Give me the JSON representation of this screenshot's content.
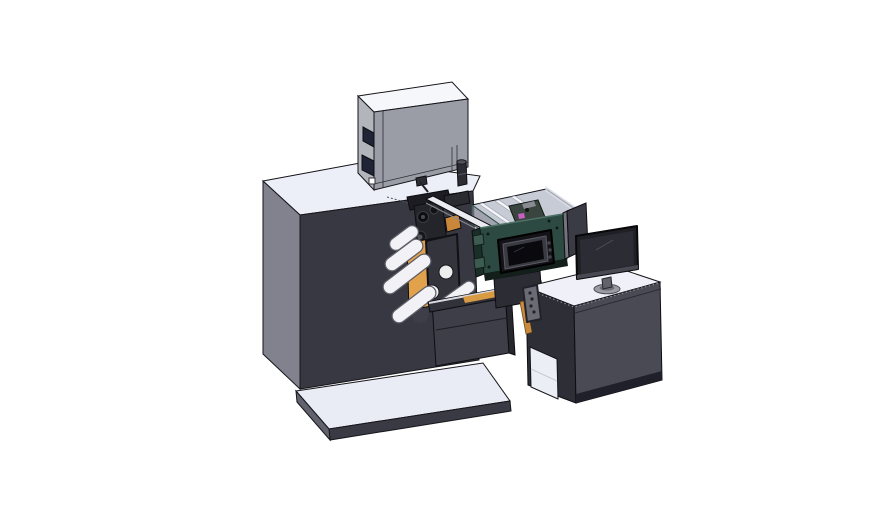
{
  "meta": {
    "width": 888,
    "height": 522,
    "background": "#ffffff",
    "scene": "isometric CAD render of a label printing machine with operator desk"
  },
  "parts": [
    {
      "id": "main-cabinet",
      "label": "main machine cabinet"
    },
    {
      "id": "printer-enclosure",
      "label": "printer enclosure box on cabinet top"
    },
    {
      "id": "top-knob-cylinder",
      "label": "small cylinder fitting on cabinet top"
    },
    {
      "id": "print-mechanism",
      "label": "print head, rollers and orange media roll"
    },
    {
      "id": "media-tray",
      "label": "open tray with carriage and rails"
    },
    {
      "id": "control-unit",
      "label": "teal control box with HMI touch panel"
    },
    {
      "id": "outfeed-pedestal",
      "label": "outfeed pedestal and conveyor beam"
    },
    {
      "id": "side-shield-panel",
      "label": "shield panel behind monitor"
    },
    {
      "id": "operator-desk",
      "label": "operator desk cabinet"
    },
    {
      "id": "monitor",
      "label": "desktop monitor on stand"
    },
    {
      "id": "machine-base-plate",
      "label": "machine base plate"
    }
  ],
  "colors": {
    "background": "#ffffff",
    "cabinet_front": "#383842",
    "cabinet_side": "#82828f",
    "cabinet_top": "#edeff8",
    "box_front": "#9a9da6",
    "box_side": "#b3b5bd",
    "box_top": "#f6f7fb",
    "box_window": "#202437",
    "platform_top": "#e9ebf5",
    "platform_edge": "#3a3a44",
    "platform_side": "#62626e",
    "roller_fill": "#f2f2f6",
    "roller_edge": "#5e5e68",
    "media_orange": "#e2a24c",
    "orange_dark": "#b97d30",
    "orange_strip": "#d99a44",
    "mech_black": "#1c1c22",
    "mech_block": "#24242b",
    "plate_dark": "#34343d",
    "beam_light": "#ebecf2",
    "tray_floor": "#c7cbd5",
    "rail_white": "#f4f5f9",
    "carriage_green": "#3a453f",
    "pink_part": "#c95fc2",
    "teal_front": "#2c4a42",
    "teal_side": "#1b2f29",
    "teal_tab": "#3c5c52",
    "teal_band": "#131f1b",
    "hmi_bezel": "#141418",
    "hmi_frame": "#3a3a42",
    "hmi_screen": "#0a0a0e",
    "shield_panel": "#3b3b45",
    "shield_edge": "#74747f",
    "desk_top": "#f0f1f8",
    "desk_front": "#4a4a54",
    "desk_side": "#2e2e37",
    "desk_plinth": "#20202a",
    "desk_interior": "#eceef5",
    "monitor_bezel": "#1f1f26",
    "monitor_screen": "#2c2c34",
    "monitor_stand": "#62626d",
    "monitor_base": "#9b9ba6",
    "bracket_gray": "#6b6b76",
    "pedestal": "#3e3e48",
    "pedestal_dark": "#26262e",
    "knob_body": "#2c2c34"
  }
}
